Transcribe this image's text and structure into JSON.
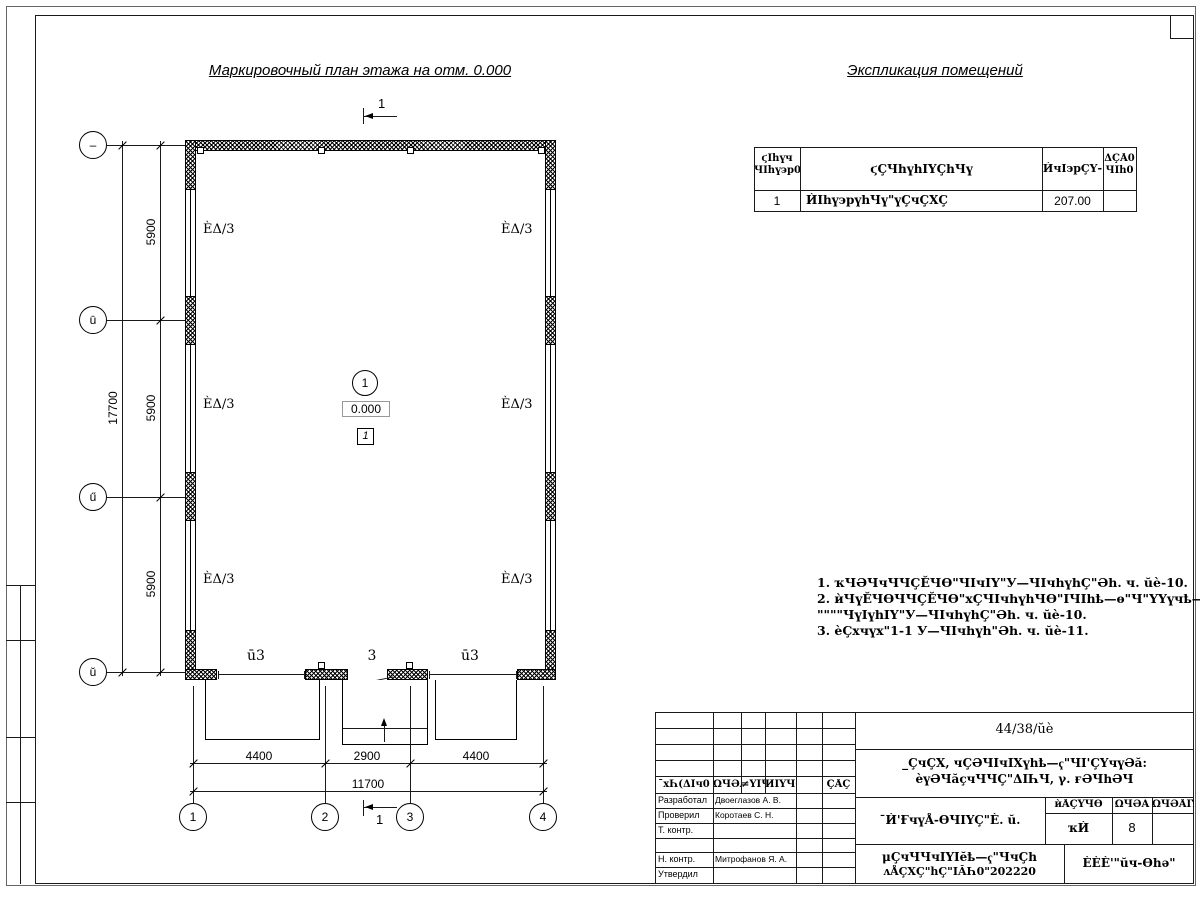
{
  "titles": {
    "plan": "Маркировочный план этажа на отм. 0.000",
    "explication": "Экспликация помещений"
  },
  "plan": {
    "room_labels": [
      "ÈΔ/3",
      "ÈΔ/3",
      "ÈΔ/3",
      "ÈΔ/3",
      "ÈΔ/3",
      "ÈΔ/3"
    ],
    "center": {
      "axis_number": "1",
      "elevation": "0.000",
      "room_number": "1"
    },
    "bottom_labels": {
      "gate_left": "ū3",
      "door": "3",
      "gate_right": "ū3"
    },
    "section_label": "1",
    "row_axes": [
      "–",
      "ū",
      "ű",
      "ŭ"
    ],
    "col_axes": [
      "1",
      "2",
      "3",
      "4"
    ],
    "dims_left": [
      "5900",
      "5900",
      "5900"
    ],
    "dim_left_total": "17700",
    "dims_bottom": [
      "4400",
      "2900",
      "4400"
    ],
    "dim_bottom_total": "11700"
  },
  "explication": {
    "headers": {
      "c1a": "ϛІһүч",
      "c1b": "ЧІһү϶р0",
      "c2": "ϛÇЧһүһІҮÇһЧү",
      "c3": "ЍчІ϶рÇҮ-",
      "c4a": "ΔÇÅ0",
      "c4b": "ЧІһ0"
    },
    "row1": {
      "num": "1",
      "name": "ЍІһү϶рүһЧү\"үÇчÇХÇ",
      "area": "207.00",
      "note": ""
    }
  },
  "notes": {
    "l1": "1. ҡЧӘЧчЧЧÇĔЧѲ\"ЧІчІY\"У—ЧІчһүһÇ\"Әһ. ч. ŭè-10.",
    "l2": "2. ѝЧүĔЧѲЧЧÇĔЧѲ\"хÇЧІчһүһЧѲ\"ІЧІһҍ—ѳ\"Ч\"YҮүчҍ—ѳ",
    "l3": "\"\"\"\"ЧүІүһІY\"У—ЧІчһүһÇ\"Әһ. ч. ŭè-10.",
    "l4": "3. ѐÇхчүх\"1-1 У—ЧІчһүһ\"Әһ. ч. ŭè-11."
  },
  "titleblock": {
    "code": "44/38/ŭè",
    "project1": "_ÇчÇХ, чÇӘЧІчІХүһҍ—ҁ\"ЧІ'ÇҮчүӘă:",
    "project2": "ѐүӘЧăҫчЧЧÇ\"ΔІҺЧ, γ. ғӘЧһӘЧ",
    "h1": "¯хҺ(ΔІч0",
    "h2": "ΩЧӘĂ",
    "h3": "≠YІЧ0",
    "h4": "ЍІҮЧ0",
    "h5": "ÇÅÇ",
    "r1l": "Разработал",
    "r1n": "Двоеглазов А. В.",
    "r2l": "Проверил",
    "r2n": "Коротаев С. Н.",
    "r3l": "Т. контр.",
    "r3n": "",
    "r4l": "Н. контр.",
    "r4n": "Митрофанов Я. А.",
    "r5l": "Утвердил",
    "r5n": "",
    "object": "¯Ѝ'ҒчүÅ-ѲЧІYÇ\"È. ŭ.",
    "s1": "ѝÅÇҮЧѲ",
    "s2": "ΩЧӘĂ",
    "s3": "ΩЧӘÅІY",
    "v1": "ҡЍ",
    "v2": "8",
    "v3": "",
    "doc1": "μÇчЧЧчІYІĕҍ—ҁ\"ЧчÇһ",
    "doc2": "ʌÅÇХÇ\"һÇ\"ІĂҺ0\"202220",
    "company": "ÈÈÈ'\"ŭч-Ѳһә\""
  }
}
